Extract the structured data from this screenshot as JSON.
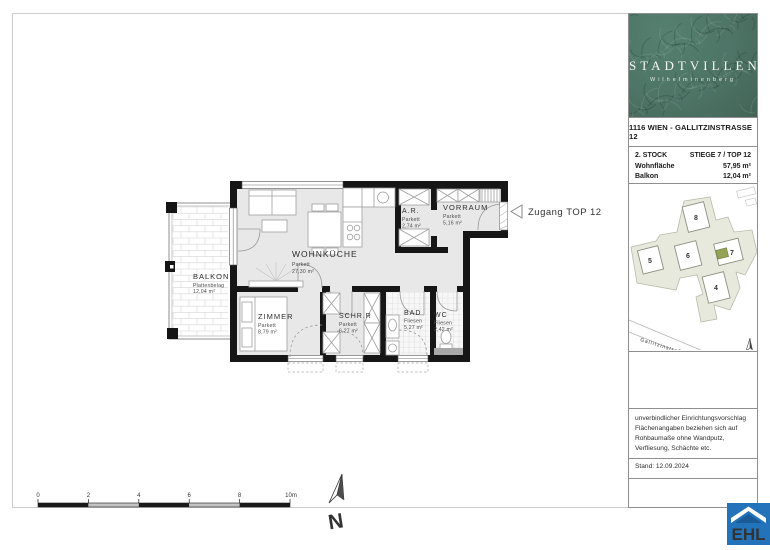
{
  "plan": {
    "rooms": {
      "balkon": {
        "name": "BALKON",
        "material": "Plattenbelag",
        "area": "12,04 m²"
      },
      "wohnkueche": {
        "name": "WOHNKÜCHE",
        "material": "Parkett",
        "area": "27,30 m²"
      },
      "zimmer": {
        "name": "ZIMMER",
        "material": "Parkett",
        "area": "8,79 m²"
      },
      "schrankraum": {
        "name": "SCHR.R",
        "material": "Parkett",
        "area": "6,27 m²"
      },
      "bad": {
        "name": "BAD",
        "material": "Fliesen",
        "area": "5,27 m²"
      },
      "wc": {
        "name": "WC",
        "material": "Fliesen",
        "area": "2,42 m²"
      },
      "abstellraum": {
        "name": "A.R.",
        "material": "Parkett",
        "area": "2,74 m²"
      },
      "vorraum": {
        "name": "VORRAUM",
        "material": "Parkett",
        "area": "5,16 m²"
      }
    },
    "entrance_label": "Zugang TOP 12",
    "scalebar": {
      "labels": [
        "0",
        "2",
        "4",
        "6",
        "8",
        "10m"
      ]
    },
    "north_label": "N"
  },
  "sidebar": {
    "logo": {
      "title": "STADTVILLEN",
      "subtitle": "Wilhelminenberg",
      "bg_color": "#4d7466"
    },
    "address": "1116 WIEN - GALLITZINSTRASSE 12",
    "info": {
      "rows": [
        {
          "label": "2. STOCK",
          "value": "STIEGE 7 / TOP 12"
        },
        {
          "label": "Wohnfläche",
          "value": "57,95 m²"
        },
        {
          "label": "Balkon",
          "value": "12,04 m²"
        }
      ]
    },
    "siteplan": {
      "buildings": [
        "4",
        "5",
        "6",
        "7",
        "8"
      ],
      "street": "Gallitzinstraße",
      "north_label": "N",
      "highlight_color": "#94a356",
      "plot_color": "#e7e9dc"
    },
    "disclaimer_lines": [
      "unverbindlicher Einrichtungsvorschlag",
      "Flächenangaben beziehen sich auf",
      "Rohbaumaße ohne Wandputz,",
      "Verfliesung, Schächte etc."
    ],
    "stand": "Stand: 12.09.2024"
  },
  "ehl": {
    "label": "EHL",
    "color": "#2273b9"
  }
}
